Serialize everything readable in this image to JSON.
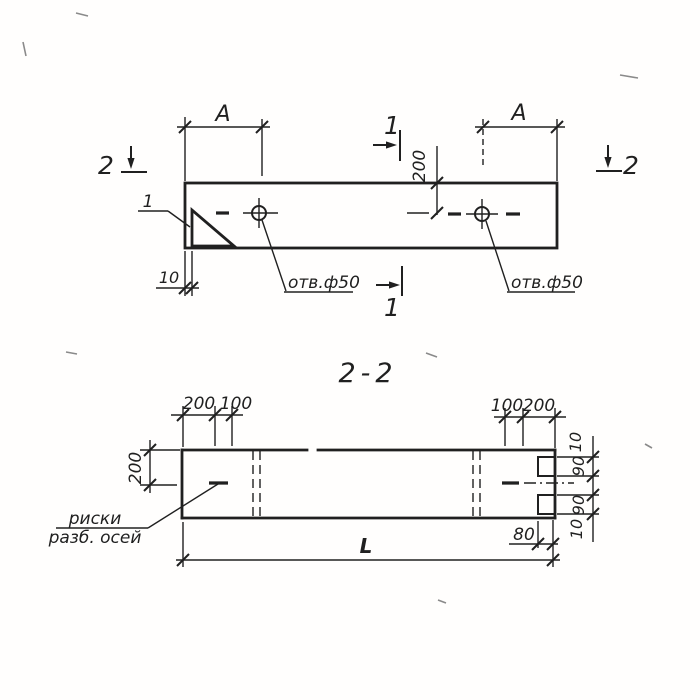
{
  "drawing": {
    "plan_view": {
      "section_mark_left": "2",
      "section_mark_right": "2",
      "section_mark_top": "1",
      "section_mark_bottom": "1",
      "detail_callout": "1",
      "dim_a_left": "A",
      "dim_a_right": "A",
      "dim_edge_to_hole": "200",
      "dim_plate_offset": "10",
      "hole_label_left": "отв.ф50",
      "hole_label_right": "отв.ф50"
    },
    "section_view": {
      "title": "2-2",
      "dim_top_left_1": "200",
      "dim_top_left_2": "100",
      "dim_top_right_1": "100",
      "dim_top_right_2": "200",
      "dim_height": "200",
      "edge_stack": [
        "10",
        "90",
        "90",
        "10"
      ],
      "dim_notch": "80",
      "dim_length": "L",
      "axis_note_line1": "риски",
      "axis_note_line2": "разб. осей"
    },
    "colors": {
      "ink": "#202020",
      "paper": "#fffefd"
    }
  }
}
